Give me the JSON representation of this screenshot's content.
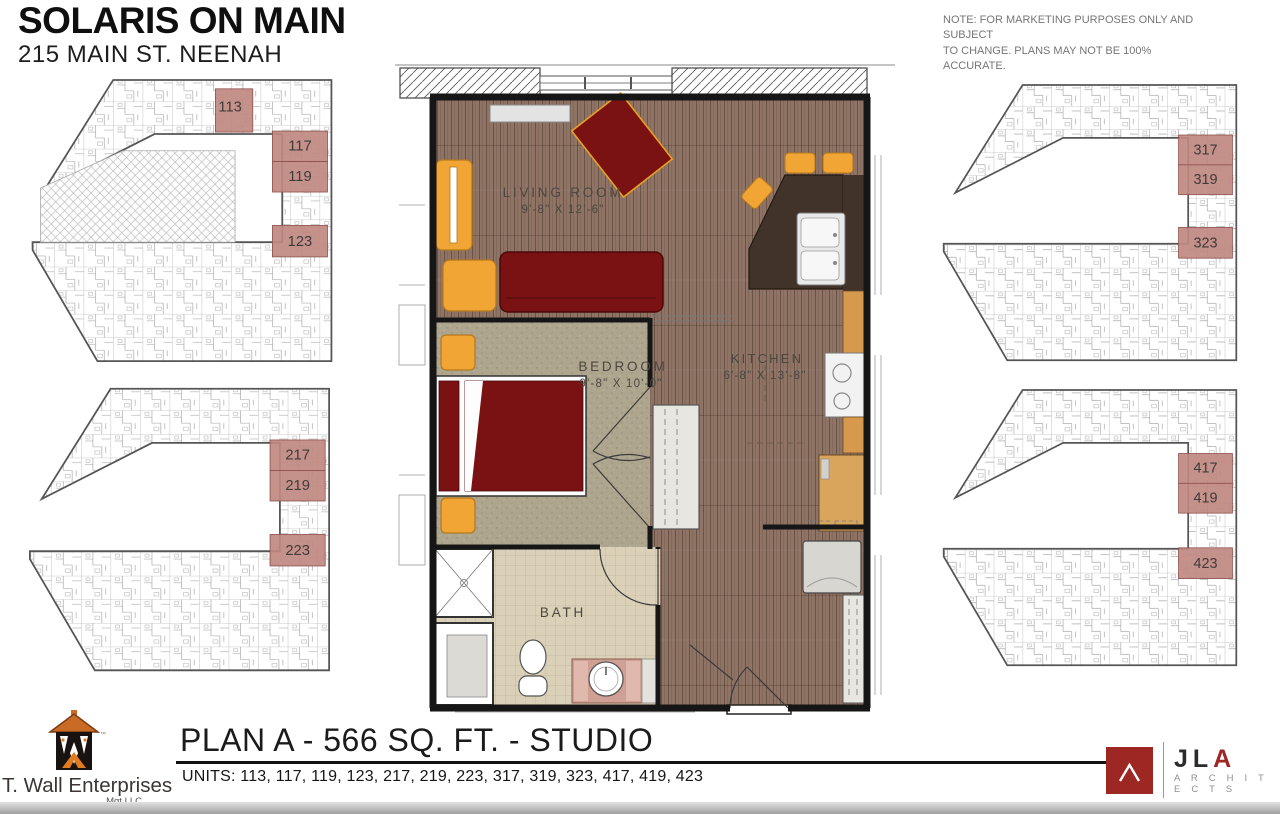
{
  "header": {
    "title": "SOLARIS ON MAIN",
    "subtitle": "215 MAIN ST. NEENAH"
  },
  "note": {
    "line1": "NOTE: FOR MARKETING PURPOSES ONLY AND SUBJECT",
    "line2": "TO CHANGE. PLANS MAY NOT BE 100% ACCURATE."
  },
  "plan": {
    "rooms": [
      {
        "name": "LIVING ROOM",
        "dims": "9'-8\" X 12'-6\""
      },
      {
        "name": "BEDROOM",
        "dims": "9'-8\" X 10'-0\""
      },
      {
        "name": "KITCHEN",
        "dims": "6'-8\" X 13'-8\""
      },
      {
        "name": "BATH",
        "dims": ""
      }
    ]
  },
  "buildings": [
    {
      "id": "first-floor",
      "units": [
        "113",
        "117",
        "119",
        "123"
      ]
    },
    {
      "id": "second-floor",
      "units": [
        "217",
        "219",
        "223"
      ]
    },
    {
      "id": "third-floor",
      "units": [
        "317",
        "319",
        "323"
      ]
    },
    {
      "id": "fourth-floor",
      "units": [
        "417",
        "419",
        "423"
      ]
    }
  ],
  "footer": {
    "plan_title": "PLAN A - 566 SQ. FT. - STUDIO",
    "units_label": "UNITS:",
    "units_list": " 113, 117, 119, 123, 217, 219, 223, 317, 319, 323, 417, 419, 423"
  },
  "logos": {
    "twall": {
      "name": "T. Wall Enterprises",
      "sub": "Mgt LLC",
      "tm": "™"
    },
    "jla": {
      "jl": "JL",
      "a": "A",
      "architects": "A R C H I T E C T S"
    }
  },
  "colors": {
    "unit_highlight": "#c08881",
    "furniture_red": "#7a1113",
    "accent_yellow": "#f0a535",
    "wood": "#8f7466",
    "carpet": "#ada58e",
    "tile": "#dbd1b8",
    "counter_dark": "#41332a",
    "cabinet_orange": "#d6994e",
    "jla_red": "#9c2723",
    "twall_orange": "#c96a26"
  }
}
